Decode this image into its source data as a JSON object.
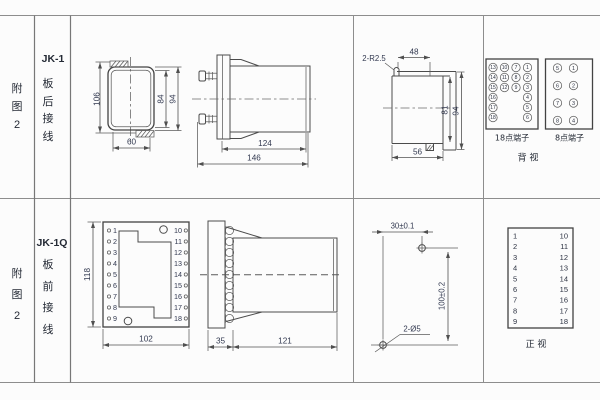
{
  "top": {
    "fig_label": "附图2",
    "model": "JK-1",
    "mount_label": "板后接线",
    "rear_case": {
      "d106": "106",
      "d84": "84",
      "d94": "94",
      "d60": "60"
    },
    "side": {
      "d124": "124",
      "d146": "146"
    },
    "cutout": {
      "radius_note": "2-R2.5",
      "d48": "48",
      "d81": "81",
      "d94": "94",
      "d56": "56"
    },
    "t18": {
      "label": "18点端子",
      "col1": [
        "13",
        "14",
        "15",
        "16",
        "17",
        "18"
      ],
      "col2": [
        "10",
        "11",
        "12"
      ],
      "col3": [
        "7",
        "8",
        "9"
      ],
      "col4": [
        "1",
        "2",
        "3",
        "4",
        "5",
        "6"
      ]
    },
    "t8": {
      "label": "8点端子",
      "left": [
        "5",
        "6",
        "7",
        "8"
      ],
      "right": [
        "1",
        "2",
        "3",
        "4"
      ]
    },
    "rear_view_label": "背  视"
  },
  "bottom": {
    "fig_label": "附图2",
    "model": "JK-1Q",
    "mount_label": "板前接线",
    "wiring_face": {
      "d118": "118",
      "d102": "102",
      "left": [
        "1",
        "2",
        "3",
        "4",
        "5",
        "6",
        "7",
        "8",
        "9"
      ],
      "right": [
        "10",
        "11",
        "12",
        "13",
        "14",
        "15",
        "16",
        "17",
        "18"
      ]
    },
    "side": {
      "d35": "35",
      "d121": "121"
    },
    "drill": {
      "d30": "30±0.1",
      "d100": "100±0.2",
      "holes": "2-Ø5"
    },
    "front_table": {
      "left": [
        "1",
        "2",
        "3",
        "4",
        "5",
        "6",
        "7",
        "8",
        "9"
      ],
      "right": [
        "10",
        "11",
        "12",
        "13",
        "14",
        "15",
        "16",
        "17",
        "18"
      ],
      "label": "正  视"
    }
  }
}
